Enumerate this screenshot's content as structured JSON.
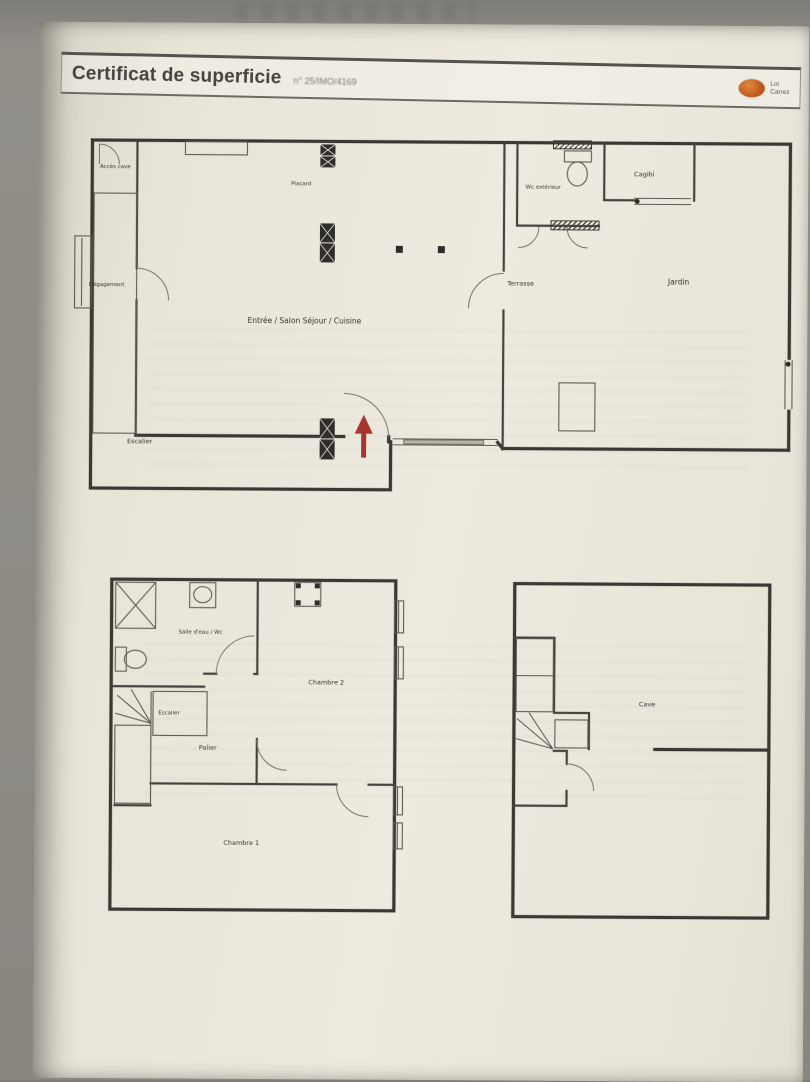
{
  "header": {
    "title": "Certificat de superficie",
    "reference": "n° 25/IMO/4169",
    "logo": {
      "line1": "Loi",
      "line2": "Carrez"
    }
  },
  "plans": {
    "ground_floor": {
      "labels": {
        "acces_cave": "Accès cave",
        "degagement": "Dégagement",
        "escalier": "Escalier",
        "main_room": "Entrée / Salon Séjour / Cuisine",
        "placard": "Placard",
        "terrasse": "Terrasse",
        "wc": "Wc extérieur",
        "cagibi": "Cagibi",
        "jardin": "Jardin"
      }
    },
    "first_floor": {
      "labels": {
        "salle_eau": "Salle d'eau / Wc",
        "chambre_2": "Chambre 2",
        "escalier": "Escalier",
        "palier": "Palier",
        "chambre_1": "Chambre 1"
      }
    },
    "basement": {
      "labels": {
        "cave": "Cave"
      }
    }
  },
  "colors": {
    "accent_orange": "#bf5a1d",
    "arrow_red": "#a63530",
    "ink": "#3b3833",
    "paper": "#e9e6db",
    "photo_background": "#8e8b86"
  }
}
